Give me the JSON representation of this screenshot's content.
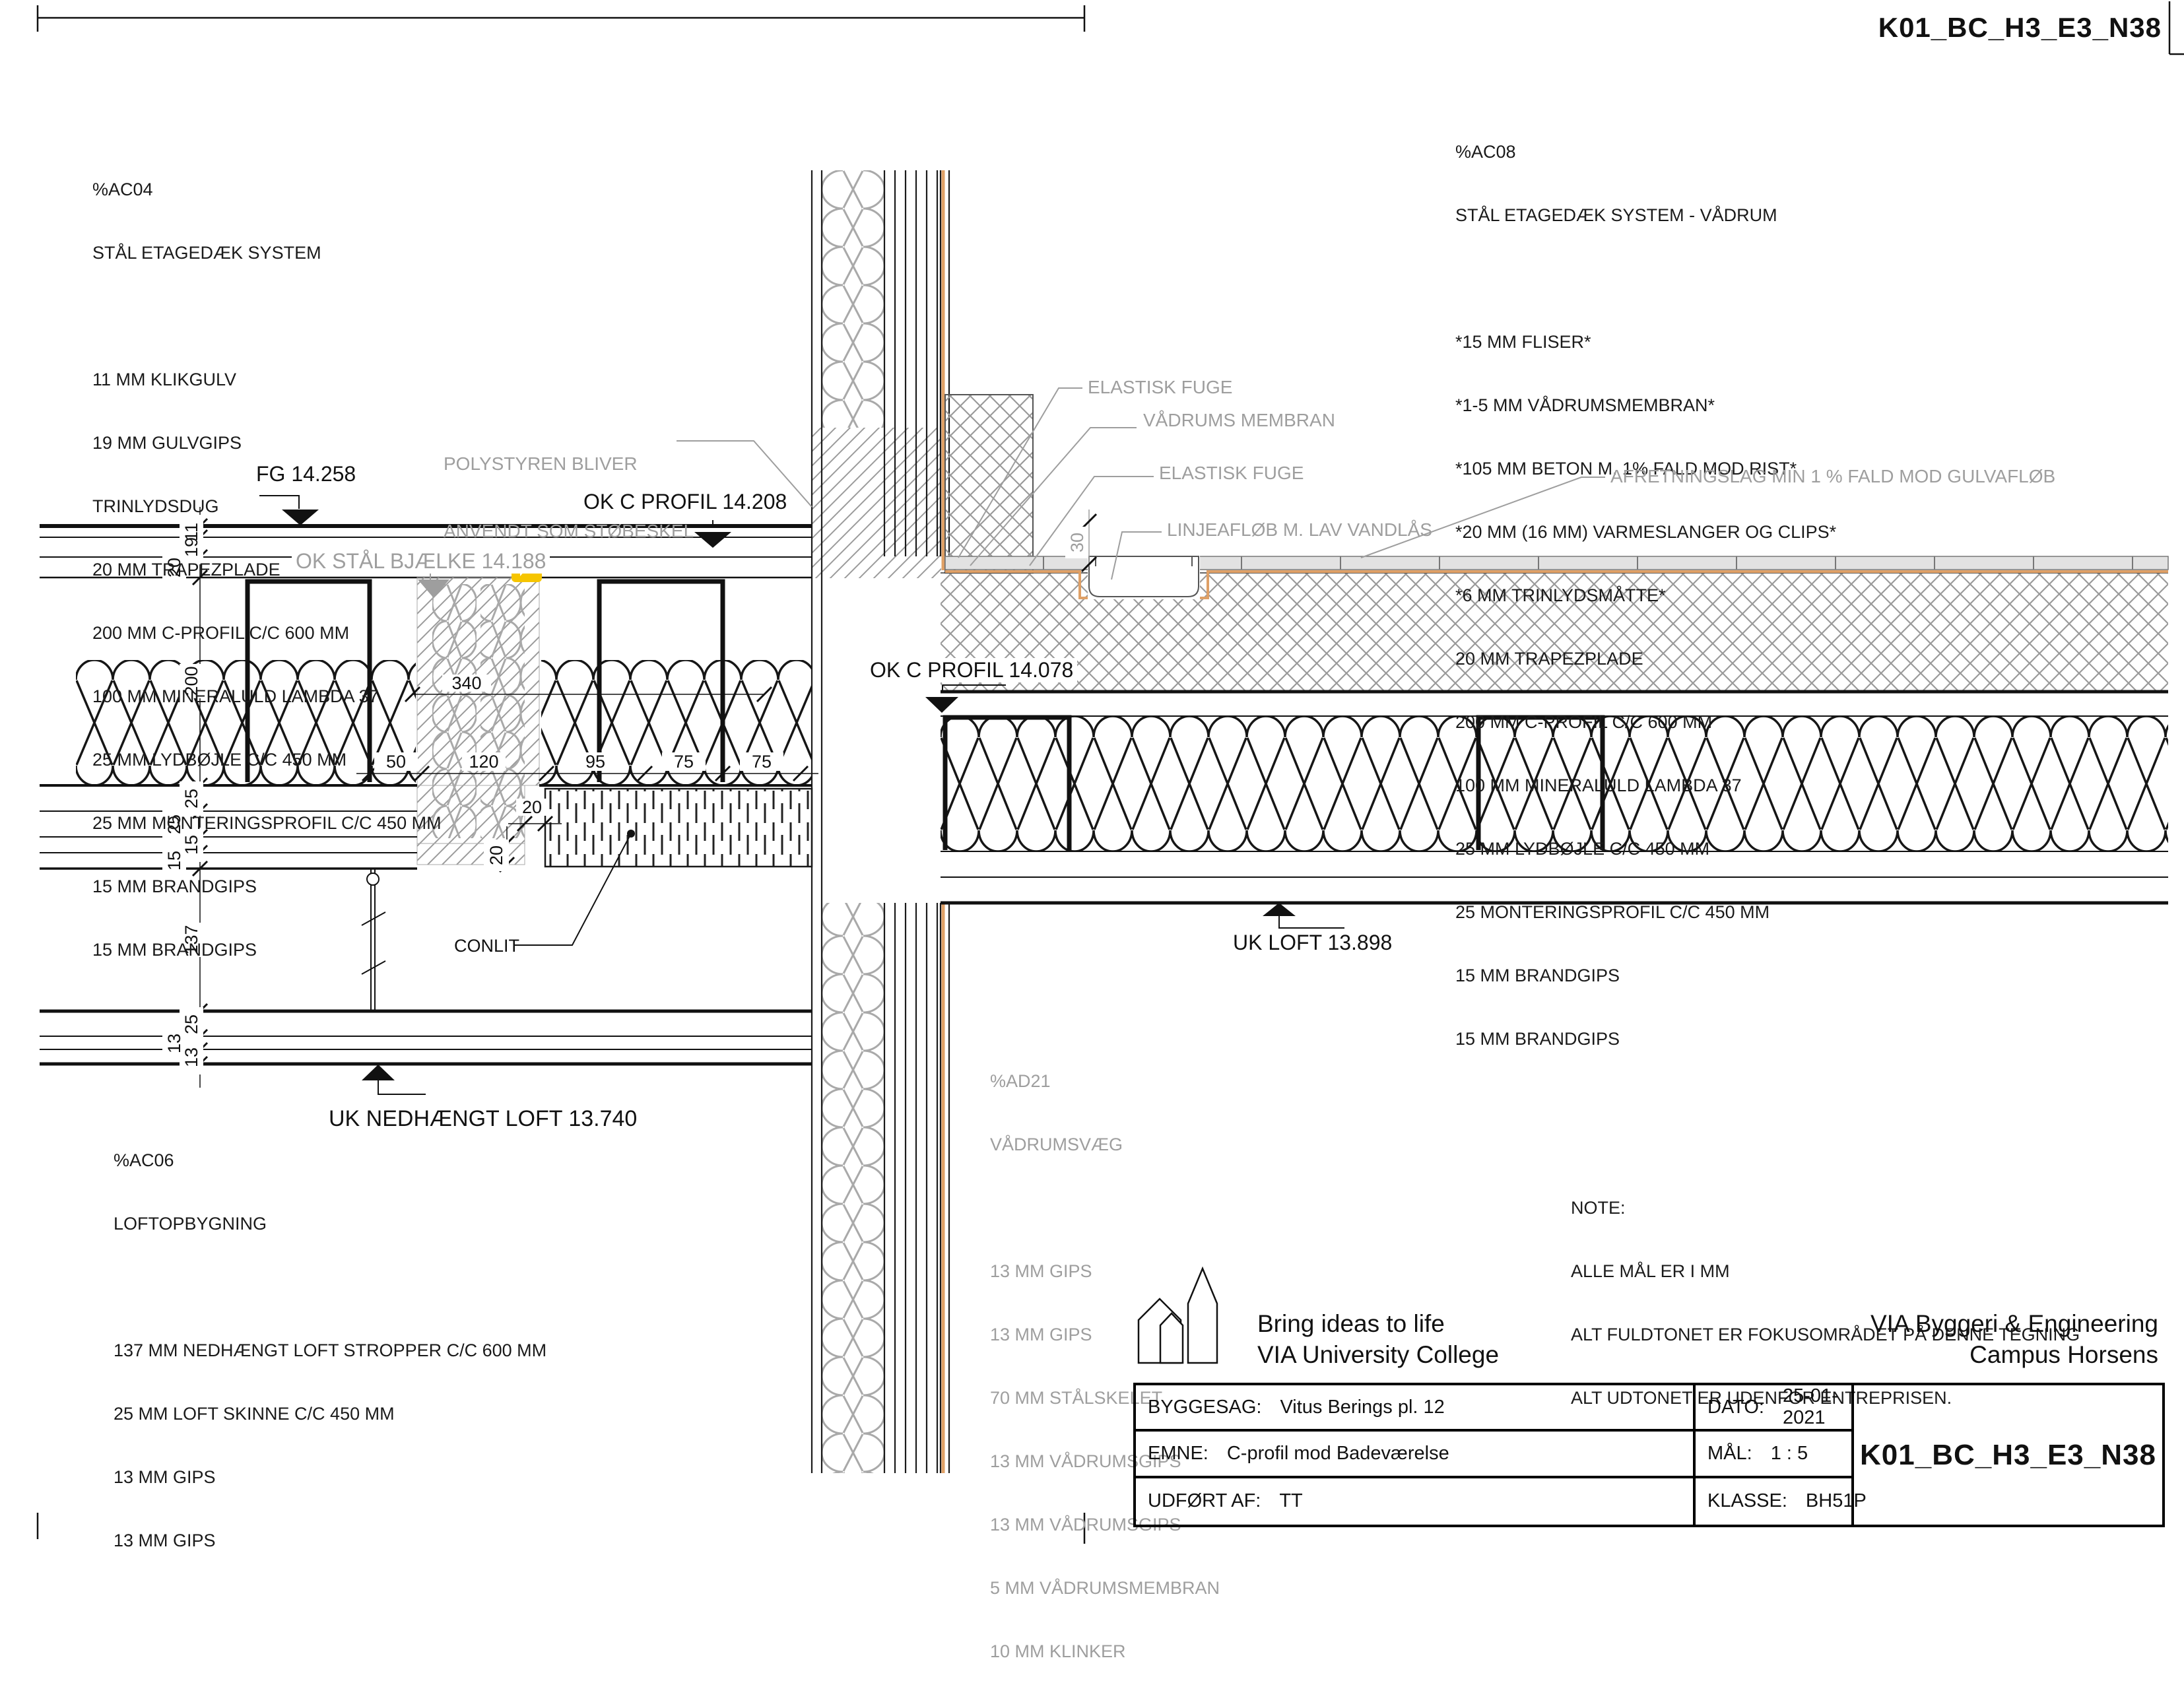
{
  "meta": {
    "sheet_type": "construction detail drawing"
  },
  "layer_blocks": {
    "ac04": {
      "code": "%AC04",
      "title": "STÅL ETAGEDÆK SYSTEM",
      "lines": [
        "11 MM KLIKGULV",
        "19 MM GULVGIPS",
        "TRINLYDSDUG",
        "20 MM TRAPEZPLADE",
        "200 MM C-PROFIL C/C 600 MM",
        "100 MM MINERALULD LAMBDA 37",
        "25 MM LYDBØJLE C/C 450 MM",
        "25 MM MONTERINGSPROFIL C/C 450 MM",
        "15 MM BRANDGIPS",
        "15 MM BRANDGIPS"
      ]
    },
    "ac08": {
      "code": "%AC08",
      "title": "STÅL ETAGEDÆK SYSTEM - VÅDRUM",
      "lines": [
        "*15 MM FLISER*",
        "*1-5 MM VÅDRUMSMEMBRAN*",
        "*105 MM BETON M. 1% FALD MOD RIST*",
        "*20 MM (16 MM) VARMESLANGER OG CLIPS*",
        "*6 MM TRINLYDSMÅTTE*",
        "20 MM TRAPEZPLADE",
        "200 MM C-PROFIL C/C 600 MM",
        "100 MM MINERALULD LAMBDA 37",
        "25 MM LYDBØJLE C/C 450 MM",
        "25 MONTERINGSPROFIL C/C 450 MM",
        "15 MM BRANDGIPS",
        "15 MM BRANDGIPS"
      ]
    },
    "ac06": {
      "code": "%AC06",
      "title": "LOFTOPBYGNING",
      "lines": [
        "137 MM NEDHÆNGT LOFT STROPPER C/C 600 MM",
        "25 MM LOFT SKINNE C/C 450 MM",
        "13 MM GIPS",
        "13 MM GIPS"
      ]
    },
    "ad21": {
      "code": "%AD21",
      "title": "VÅDRUMSVÆG",
      "lines": [
        "13 MM GIPS",
        "13 MM GIPS",
        "70 MM STÅLSKELET",
        "13 MM VÅDRUMSGIPS",
        "13 MM VÅDRUMSGIPS",
        "5 MM VÅDRUMSMEMBRAN",
        "10 MM KLINKER"
      ]
    }
  },
  "note": {
    "title": "NOTE:",
    "lines": [
      "ALLE MÅL ER I MM",
      "ALT FULDTONET ER FOKUSOMRÅDET PÅ DENNE TEGNING",
      "ALT UDTONET ER UDENFOR ENTREPRISEN."
    ]
  },
  "annotations": {
    "polystyren_line1": "POLYSTYREN BLIVER",
    "polystyren_line2": "ANVENDT SOM STØBESKEL",
    "elastisk_fuge_1": "ELASTISK FUGE",
    "vadrums_membran": "VÅDRUMS MEMBRAN",
    "elastisk_fuge_2": "ELASTISK FUGE",
    "linjeafloeb": "LINJEAFLØB M. LAV VANDLÅS",
    "afretningslag": "AFRETNINGSLAG MIN 1 % FALD MOD GULVAFLØB",
    "conlit": "CONLIT"
  },
  "levels": {
    "fg": "FG 14.258",
    "ok_c_profil_top": "OK C PROFIL 14.208",
    "ok_staal_bjaelke": "OK STÅL BJÆLKE 14.188",
    "ok_c_profil_bad": "OK C PROFIL 14.078",
    "uk_loft": "UK LOFT 13.898",
    "uk_nedhaengt_loft": "UK NEDHÆNGT LOFT 13.740"
  },
  "dims": {
    "v": [
      "11",
      "19",
      "20",
      "200",
      "25",
      "25",
      "15",
      "15",
      "137",
      "25",
      "13",
      "13"
    ],
    "h": [
      "50",
      "120",
      "95",
      "75",
      "75"
    ],
    "beam": "340",
    "gap_a": "20",
    "gap_b": "20",
    "drain": "30"
  },
  "titleblock": {
    "tagline1": "Bring ideas to life",
    "tagline2": "VIA University College",
    "org1": "VIA Byggeri & Engineering",
    "org2": "Campus Horsens",
    "byggesag_label": "BYGGESAG:",
    "byggesag_value": "Vitus Berings pl. 12",
    "dato_label": "DATO:",
    "dato_value": "25-01-2021",
    "emne_label": "EMNE:",
    "emne_value": "C-profil mod Badeværelse",
    "maal_label": "MÅL:",
    "maal_value": "1 : 5",
    "udfoert_label": "UDFØRT AF:",
    "udfoert_value": "TT",
    "klasse_label": "KLASSE:",
    "klasse_value": "BH51P",
    "drawing_no": "K01_BC_H3_E3_N38"
  },
  "colors": {
    "annotation_gray": "#9e9e9e",
    "membrane_orange": "#dfa066",
    "comment_icon_yellow": "#f6c500"
  }
}
